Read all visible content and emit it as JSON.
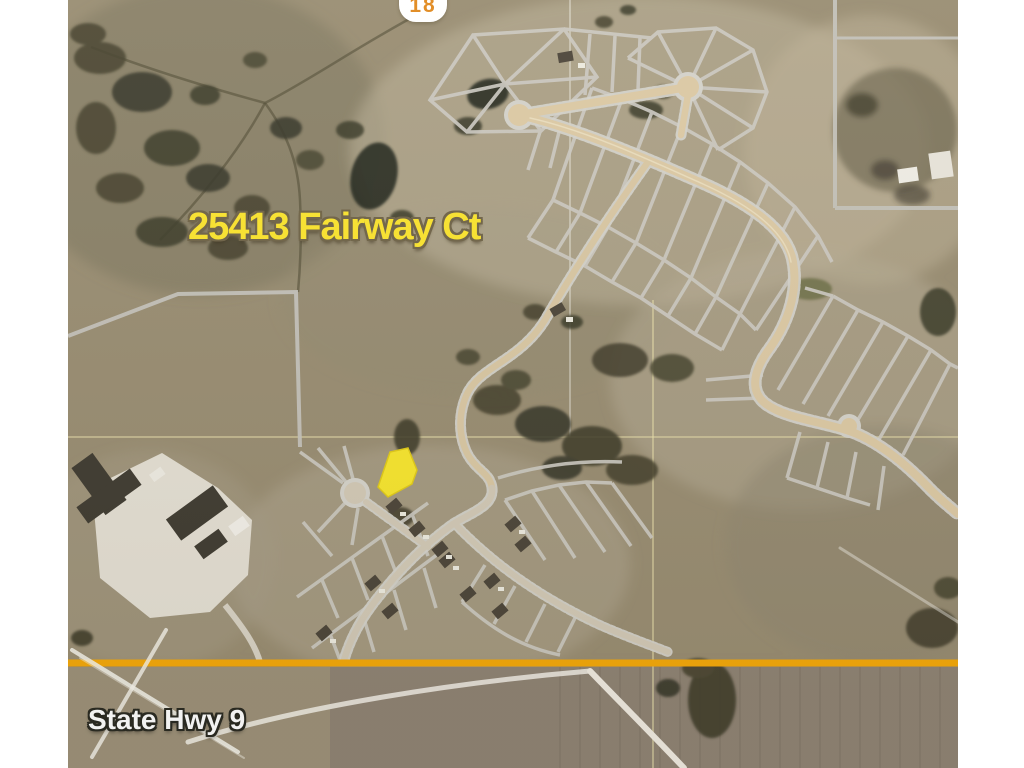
{
  "map": {
    "address_label": "25413 Fairway Ct",
    "shield_number": "18",
    "highway_label": "State Hwy 9",
    "colors": {
      "parcel_highlight": "#F7E52E",
      "highway_line": "#F4A80A",
      "address_text": "#FBE42E",
      "highway_label_text": "#FFFFFF",
      "shield_number_text": "#E0881C",
      "lot_lines": "#CCC9C1",
      "road_fill": "#DCC9A4",
      "terrain_base": "#998D72"
    }
  }
}
